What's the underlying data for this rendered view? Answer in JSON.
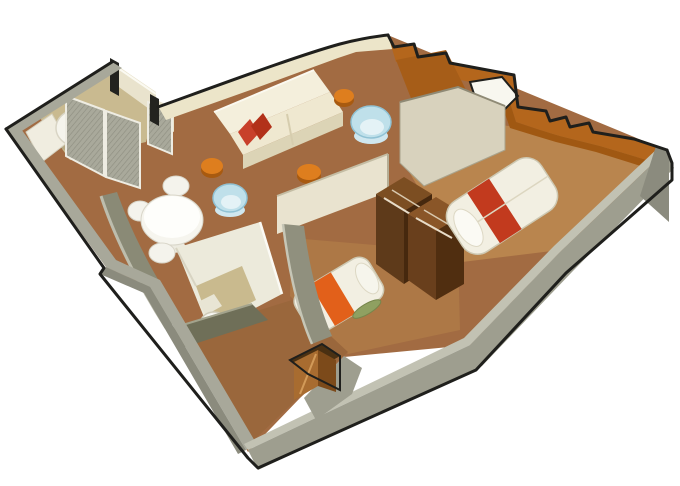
{
  "figure": {
    "kind": "isometric-3d-floor-plan-render",
    "subject": "cruise-ship-stateroom-suite",
    "rooms": [
      {
        "id": "bathroom-1",
        "furniture": [
          "round-bathtub",
          "vanity-counter",
          "mesh-sliding-doors"
        ]
      },
      {
        "id": "living-dining-room",
        "furniture": [
          "sofa",
          "red-cushions",
          "round-side-tables",
          "tub-armchairs",
          "dining-table",
          "dining-chairs",
          "desk"
        ]
      },
      {
        "id": "master-bedroom",
        "furniture": [
          "double-bed-red-stripe",
          "open-wardrobe"
        ]
      },
      {
        "id": "second-bedroom",
        "furniture": [
          "single-bed-orange-stripe",
          "green-bolster",
          "open-wardrobe"
        ]
      },
      {
        "id": "bathroom-2",
        "furniture": [
          "shower-stall",
          "toilet"
        ]
      },
      {
        "id": "entry-corridor",
        "furniture": [
          "storage-nook"
        ]
      }
    ]
  },
  "palette": {
    "background": "#ffffff",
    "outline": "#1f1f1c",
    "outer_wall_top": "#c2c2b3",
    "outer_wall_face": "#9e9e8f",
    "outer_wall_band": "#a8a89a",
    "inner_wall_olive": "#8a8a76",
    "swoop_wall_olive": "#90907e",
    "cream_wall": "#ece5c9",
    "wood_wall": "#b4661c",
    "desk_wood": "#a65d18",
    "floor_main": "#a26b42",
    "floor_master": "#b9854e",
    "floor_twin": "#ad7846",
    "floor_corridor": "#9a673c",
    "bath_tile": "#c9ba90",
    "mesh_base": "#a9a99b",
    "fixture_white": "#f5f4ec",
    "sofa_cream": "#f4efdc",
    "pillow_red": "#c8402a",
    "stool_orange": "#de7e1e",
    "chair_blue": "#bfe0ea",
    "table_white": "#f6f5ee",
    "wardrobe_dark": "#5e3a1a",
    "wardrobe_top": "#7c4e22",
    "bed_white": "#f2efe2",
    "bed_stripe_red": "#c23a1e",
    "bed_stripe_orange": "#e2601a",
    "pillow_green": "#8fa061",
    "nook_copper": "#a86c30",
    "shower_wall": "#eceadb",
    "olive_front_wall": "#6f6f58"
  }
}
